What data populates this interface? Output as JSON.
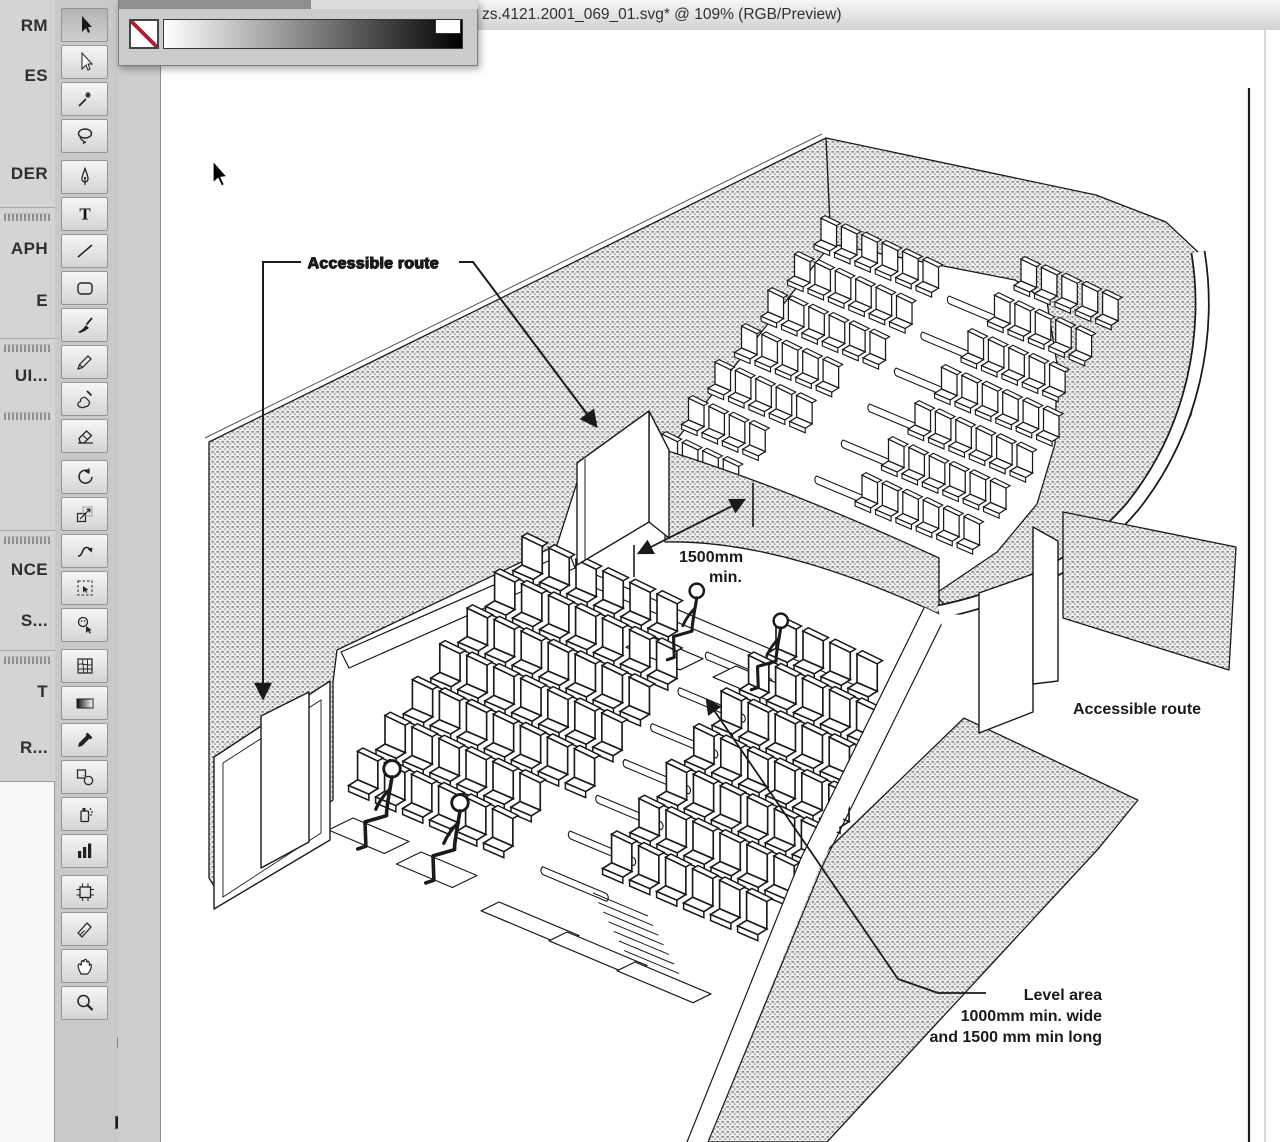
{
  "window": {
    "title": "zs.4121.2001_069_01.svg* @ 109% (RGB/Preview)"
  },
  "left_strip": {
    "items": [
      {
        "t": "label",
        "y": 16,
        "text": "RM"
      },
      {
        "t": "label",
        "y": 66,
        "text": "ES"
      },
      {
        "t": "label",
        "y": 164,
        "text": "DER"
      },
      {
        "t": "sep",
        "y": 207
      },
      {
        "t": "handle",
        "y": 213
      },
      {
        "t": "label",
        "y": 239,
        "text": "APH"
      },
      {
        "t": "label",
        "y": 291,
        "text": "E"
      },
      {
        "t": "sep",
        "y": 338
      },
      {
        "t": "handle",
        "y": 344
      },
      {
        "t": "label",
        "y": 366,
        "text": "UI..."
      },
      {
        "t": "handle",
        "y": 412
      },
      {
        "t": "sep",
        "y": 530
      },
      {
        "t": "handle",
        "y": 536
      },
      {
        "t": "label",
        "y": 560,
        "text": "NCE"
      },
      {
        "t": "label",
        "y": 611,
        "text": "S..."
      },
      {
        "t": "sep",
        "y": 650
      },
      {
        "t": "handle",
        "y": 656
      },
      {
        "t": "label",
        "y": 682,
        "text": "T"
      },
      {
        "t": "label",
        "y": 738,
        "text": "R..."
      },
      {
        "t": "panel",
        "y": 781,
        "h": 361
      }
    ]
  },
  "toolbar": {
    "tools": [
      "selection",
      "direct-selection",
      "magic-wand",
      "lasso",
      "pen",
      "type",
      "line-segment",
      "rectangle",
      "paintbrush",
      "pencil",
      "blob-brush",
      "eraser",
      "rotate",
      "scale",
      "warp",
      "free-transform",
      "live-paint-selection",
      "mesh",
      "gradient",
      "eyedropper",
      "blend",
      "symbol-sprayer",
      "column-graph",
      "artboard",
      "slice",
      "hand",
      "zoom"
    ],
    "selected": "selection",
    "group_breaks": [
      3,
      11,
      16,
      22
    ]
  },
  "palette": {
    "ramp_from": "#ffffff",
    "ramp_to": "#000000",
    "none_slash_color": "#b01f3a"
  },
  "annotations": {
    "accessible_route_top": "Accessible route",
    "accessible_route_right": "Accessible route",
    "dim_1500_line1": "1500mm",
    "dim_1500_line2": "min.",
    "level_area_line1": "Level area",
    "level_area_line2": "1000mm min. wide",
    "level_area_line3": "and 1500 mm min long"
  },
  "diagram": {
    "seat_blocks": [
      {
        "name": "upper-left",
        "layer": "lay-upper-seats",
        "x": 820,
        "y": 240,
        "seat_dx": 20.4,
        "seat_dy": 8.3,
        "row_dx": -26.5,
        "row_dy": 36,
        "counts": [
          6,
          6,
          6,
          5,
          5,
          4,
          4
        ],
        "scale": 1.15
      },
      {
        "name": "upper-right",
        "layer": "lay-upper-seats",
        "x": 1020,
        "y": 281,
        "seat_dx": 20.4,
        "seat_dy": 8.3,
        "row_dx": -26.5,
        "row_dy": 36,
        "counts": [
          5,
          5,
          5,
          6,
          6,
          6,
          6
        ],
        "scale": 1.15
      },
      {
        "name": "lower-left",
        "layer": "lay-lower-seats",
        "x": 521,
        "y": 565,
        "seat_dx": 27,
        "seat_dy": 11.5,
        "row_dx": -27.4,
        "row_dy": 35.8,
        "counts": [
          6,
          7,
          7,
          7,
          7,
          6,
          6
        ],
        "scale": 1.5
      },
      {
        "name": "lower-right",
        "layer": "lay-lower-seats",
        "x": 775,
        "y": 648,
        "seat_dx": 27,
        "seat_dy": 11.5,
        "row_dx": -27.4,
        "row_dy": 35.8,
        "counts": [
          4,
          5,
          5,
          6,
          6,
          6,
          6
        ],
        "scale": 1.5
      }
    ],
    "hairpin_groups": [
      {
        "layer": "lay-upper-floor",
        "x": 948,
        "y": 296,
        "count": 6,
        "step_dx": -26.5,
        "step_dy": 36,
        "dx": 50,
        "dy": 21
      },
      {
        "layer": "lay-lower-floor",
        "x": 706,
        "y": 652,
        "count": 7,
        "step_dx": -27.4,
        "step_dy": 35.8,
        "dx": 62,
        "dy": 26
      }
    ],
    "stair_groups": [
      {
        "layer": "lay-upper-floor",
        "x": 672,
        "y": 458,
        "count": 9,
        "step_dx": 5.3,
        "step_dy": 9.4,
        "dx": 42,
        "dy": 18
      },
      {
        "layer": "lay-lower-floor",
        "x": 592,
        "y": 893,
        "count": 10,
        "step_dx": 5.2,
        "step_dy": 9.6,
        "dx": 55,
        "dy": 23
      }
    ],
    "platforms": [
      {
        "layer": "lay-lower-floor",
        "x": 352,
        "y": 818,
        "w": 56,
        "d": 30
      },
      {
        "layer": "lay-lower-floor",
        "x": 420,
        "y": 852,
        "w": 56,
        "d": 30
      },
      {
        "layer": "lay-lower-floor",
        "x": 648,
        "y": 636,
        "w": 54,
        "d": 28
      },
      {
        "layer": "lay-lower-floor",
        "x": 735,
        "y": 666,
        "w": 54,
        "d": 28
      },
      {
        "layer": "lay-lower-floor",
        "x": 498,
        "y": 902,
        "w": 80,
        "d": 22
      },
      {
        "layer": "lay-lower-floor",
        "x": 566,
        "y": 932,
        "w": 80,
        "d": 22
      },
      {
        "layer": "lay-lower-floor",
        "x": 634,
        "y": 962,
        "w": 76,
        "d": 22
      }
    ],
    "figures": [
      {
        "x": 382,
        "y": 812,
        "scale": 1.8
      },
      {
        "x": 450,
        "y": 846,
        "scale": 1.8
      },
      {
        "x": 688,
        "y": 628,
        "scale": 1.55
      },
      {
        "x": 772,
        "y": 658,
        "scale": 1.55
      }
    ]
  }
}
